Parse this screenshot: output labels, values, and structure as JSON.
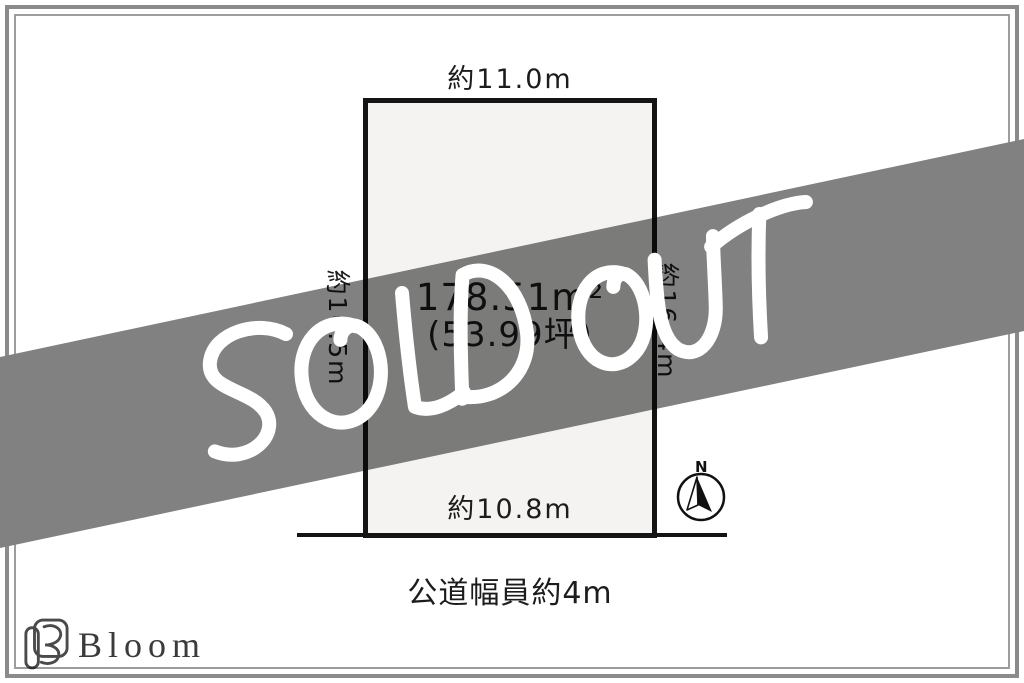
{
  "banner": {
    "text": "SOLD OUT",
    "band_color": "#818181",
    "text_color": "#ffffff"
  },
  "diagram": {
    "dims": {
      "top": "約11.0m",
      "left": "約16.5m",
      "right": "約16.4m",
      "bottom": "約10.8m"
    },
    "area": {
      "square_meters": "178.51m²",
      "tsubo": "(53.99坪)"
    },
    "road_label": "公道幅員約4m"
  },
  "compass": {
    "north_label": "N"
  },
  "logo": {
    "brand": "Bloom"
  }
}
